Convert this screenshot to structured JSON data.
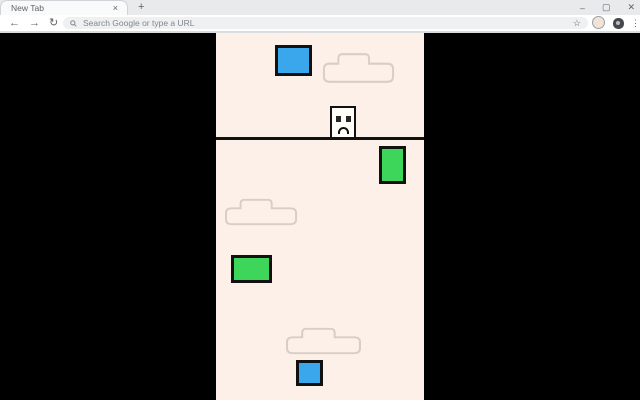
{
  "browser": {
    "tab_strip": {
      "tab_title": "New Tab",
      "close_icon": "×",
      "new_tab_button": "+",
      "window_controls": {
        "minimize": "–",
        "maximize": "▢",
        "close": "✕"
      }
    },
    "toolbar": {
      "back_icon": "←",
      "forward_icon": "→",
      "reload_icon": "↻",
      "omnibox_placeholder": "Search Google or type a URL",
      "bookmark_icon": "☆",
      "menu_icon": "⋮"
    }
  },
  "game": {
    "page_background": "#000000",
    "canvas_background": "#fdf0e8",
    "palette": {
      "blue": "#3aa7ec",
      "green": "#3ed65a",
      "border": "#111111",
      "cloud_outline": "#d8cec6",
      "player_fill": "#fffdf8"
    },
    "objects": [
      {
        "name": "blue-block-top",
        "type": "block",
        "color": "#3aa7ec",
        "x": 59,
        "y": 12,
        "w": 37,
        "h": 31
      },
      {
        "name": "cloud-top",
        "type": "cloud",
        "x": 106,
        "y": 19,
        "w": 73,
        "h": 32
      },
      {
        "name": "player-character",
        "type": "player",
        "x": 114,
        "y": 73,
        "w": 26,
        "h": 33
      },
      {
        "name": "ground-line",
        "type": "line",
        "x": 0,
        "y": 104,
        "w": 208,
        "h": 3
      },
      {
        "name": "green-block-right",
        "type": "block",
        "color": "#3ed65a",
        "x": 163,
        "y": 113,
        "w": 27,
        "h": 38
      },
      {
        "name": "cloud-middle",
        "type": "cloud",
        "x": 8,
        "y": 165,
        "w": 74,
        "h": 28
      },
      {
        "name": "green-block-left",
        "type": "block",
        "color": "#3ed65a",
        "x": 15,
        "y": 222,
        "w": 41,
        "h": 28
      },
      {
        "name": "cloud-bottom",
        "type": "cloud",
        "x": 69,
        "y": 294,
        "w": 77,
        "h": 28
      },
      {
        "name": "blue-block-bottom",
        "type": "block",
        "color": "#3aa7ec",
        "x": 80,
        "y": 327,
        "w": 27,
        "h": 26
      }
    ]
  }
}
